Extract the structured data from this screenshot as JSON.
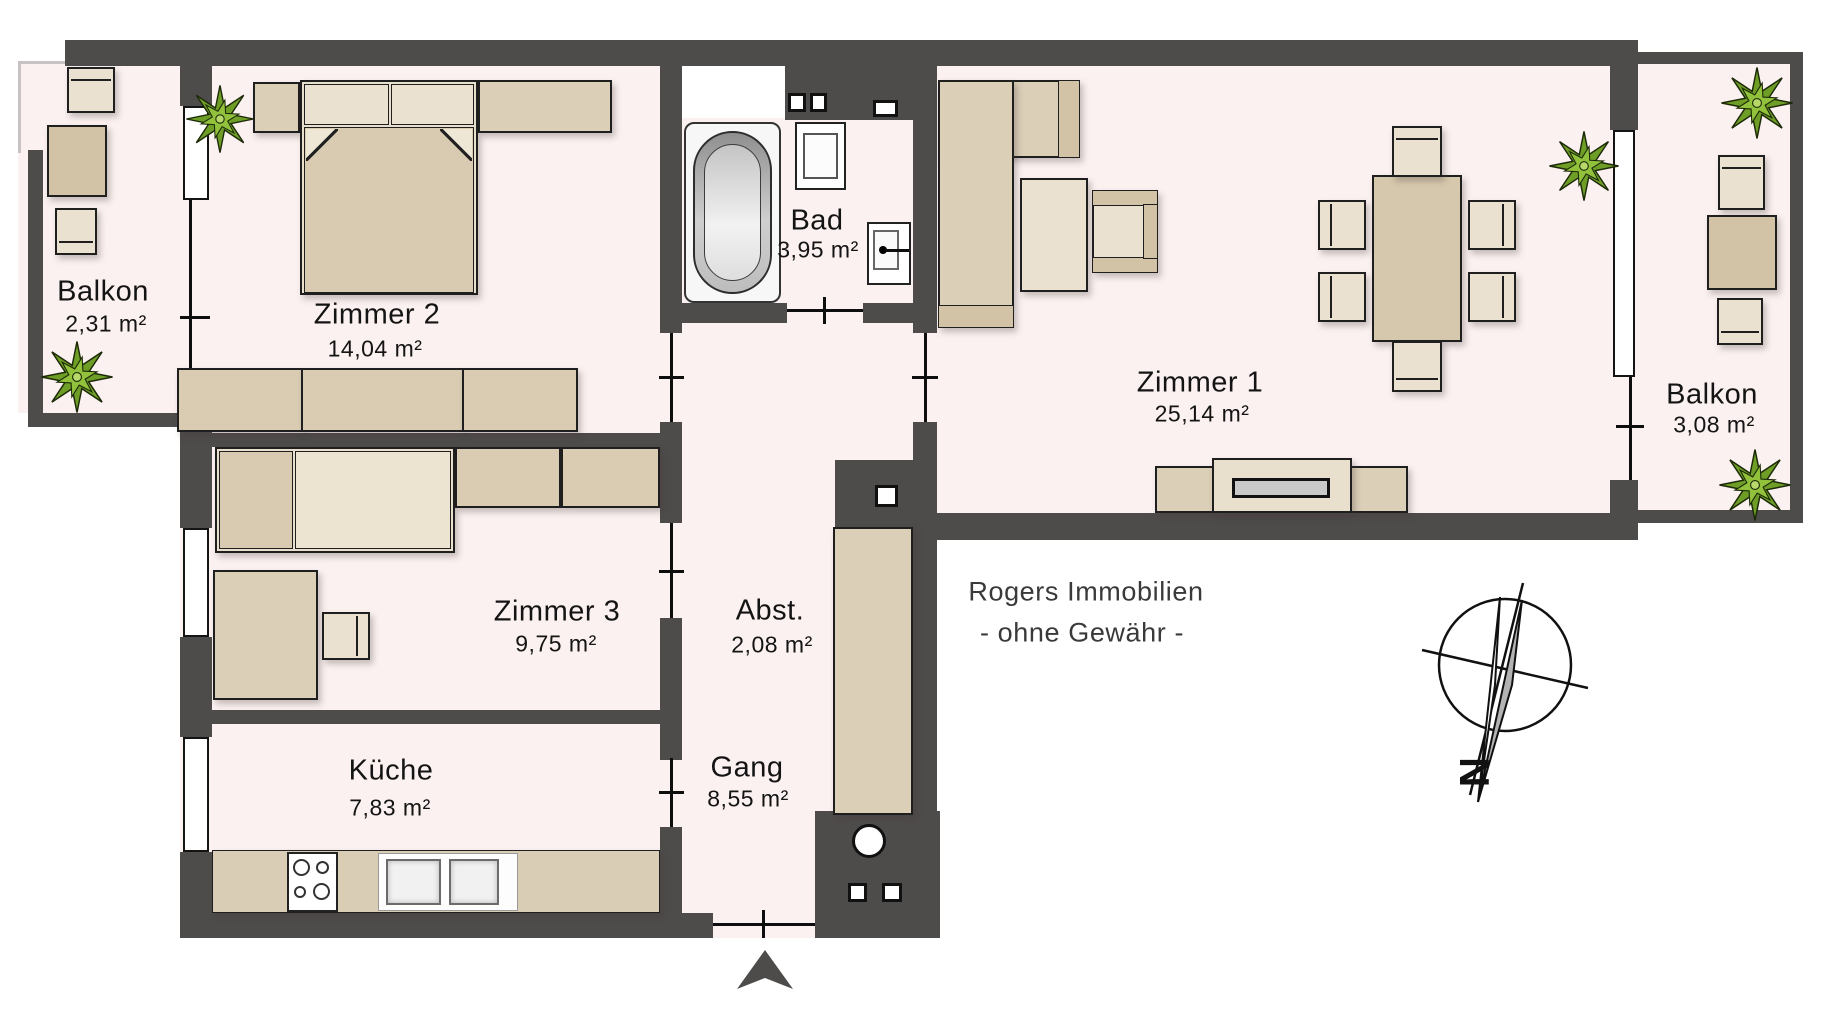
{
  "colors": {
    "wall": "#4e4b4b",
    "floor": "#fbf1f0",
    "furniture": "#dbcfb7",
    "furniture_light": "#eae1d0",
    "plant_green": "#7fae2f",
    "outside": "#ffffff"
  },
  "rooms": {
    "balkon_left": {
      "name": "Balkon",
      "area": "2,31 m²"
    },
    "zimmer2": {
      "name": "Zimmer 2",
      "area": "14,04 m²"
    },
    "bad": {
      "name": "Bad",
      "area": "3,95 m²"
    },
    "zimmer1": {
      "name": "Zimmer 1",
      "area": "25,14 m²"
    },
    "balkon_right": {
      "name": "Balkon",
      "area": "3,08 m²"
    },
    "zimmer3": {
      "name": "Zimmer 3",
      "area": "9,75 m²"
    },
    "abstellraum": {
      "name": "Abst.",
      "area": "2,08 m²"
    },
    "gang": {
      "name": "Gang",
      "area": "8,55 m²"
    },
    "kueche": {
      "name": "Küche",
      "area": "7,83 m²"
    }
  },
  "watermark": {
    "line1": "Rogers Immobilien",
    "line2": "- ohne Gewähr -"
  },
  "compass": {
    "north_label": "N"
  }
}
